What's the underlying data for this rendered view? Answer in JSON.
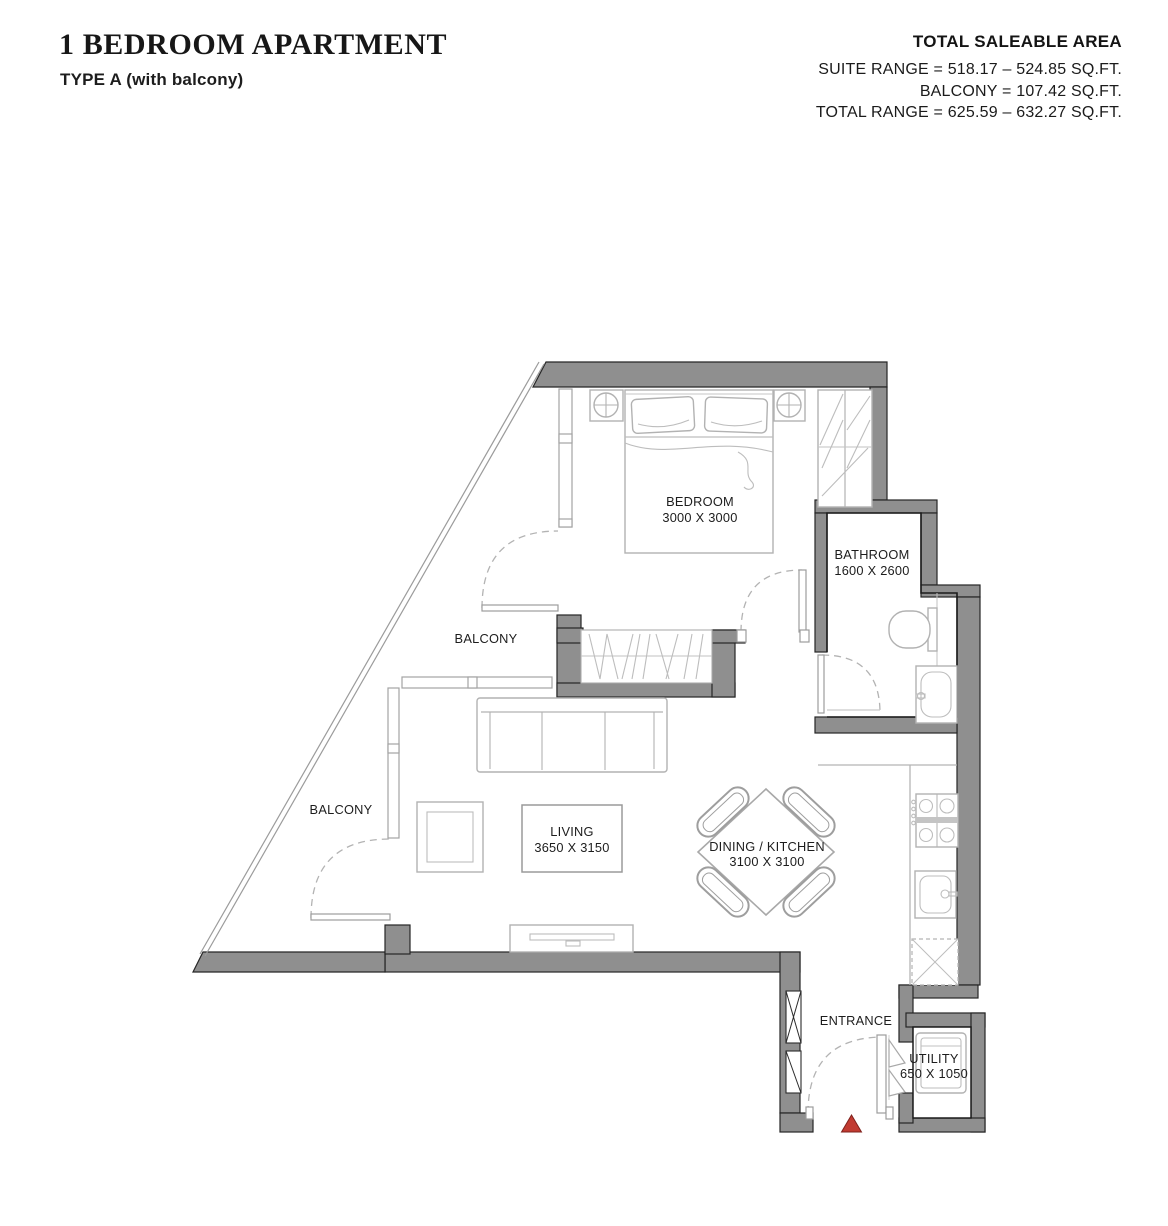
{
  "header": {
    "title": "1 BEDROOM APARTMENT",
    "subtitle": "TYPE A (with balcony)",
    "area_heading": "TOTAL SALEABLE AREA",
    "area_lines": [
      "SUITE RANGE = 518.17 – 524.85 SQ.FT.",
      "BALCONY = 107.42 SQ.FT.",
      "TOTAL RANGE = 625.59 – 632.27 SQ.FT."
    ]
  },
  "rooms": {
    "bedroom": {
      "name": "BEDROOM",
      "dims": "3000 X 3000"
    },
    "bathroom": {
      "name": "BATHROOM",
      "dims": "1600 X 2600"
    },
    "living": {
      "name": "LIVING",
      "dims": "3650 X 3150"
    },
    "dining_kitchen": {
      "name": "DINING / KITCHEN",
      "dims": "3100 X 3100"
    },
    "balcony_upper": {
      "name": "BALCONY"
    },
    "balcony_lower": {
      "name": "BALCONY"
    },
    "entrance": {
      "name": "ENTRANCE"
    },
    "utility": {
      "name": "UTILITY",
      "dims": "650 X 1050"
    }
  },
  "icons": {
    "entrance_marker": "red-triangle"
  },
  "colors": {
    "wall": "#8f8f8f",
    "furniture_line": "#b2b2b2",
    "room_outline": "#1c1c1c",
    "entrance_marker": "#c13a31",
    "text": "#1b1b1b"
  }
}
